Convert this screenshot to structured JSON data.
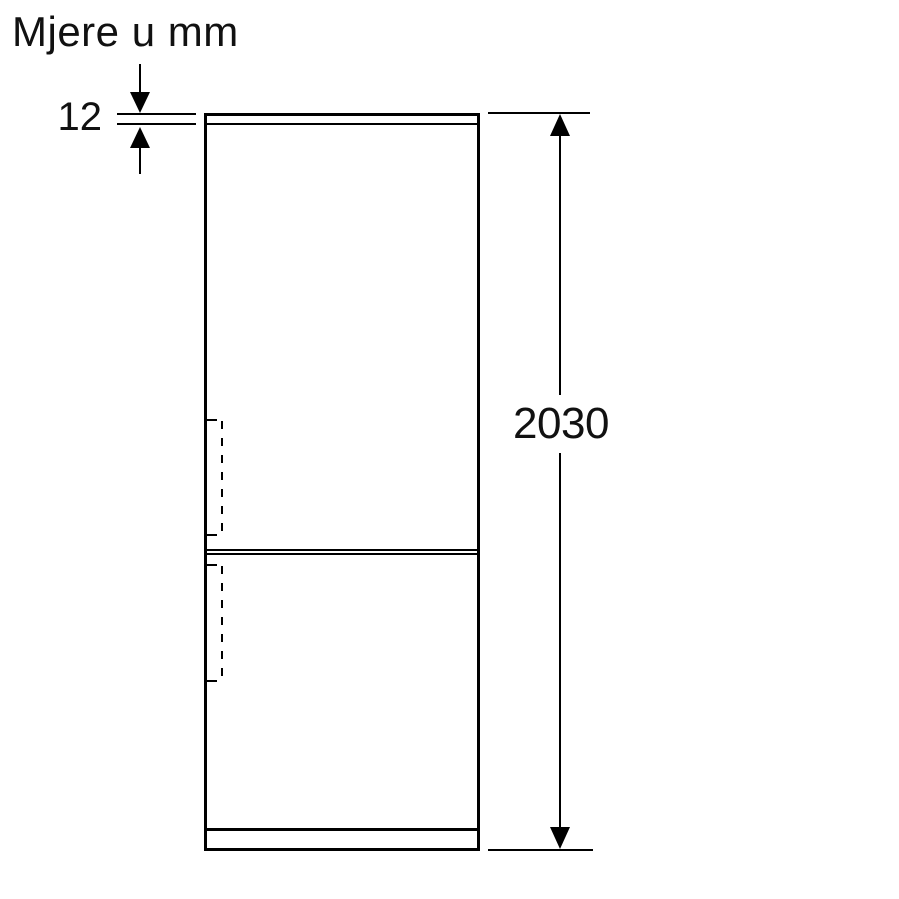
{
  "title": "Mjere u mm",
  "diagram": {
    "type": "appliance-dimension-drawing",
    "subject": "fridge-freezer-front-view",
    "background": "#ffffff",
    "line_color": "#000000",
    "text_color": "#111111",
    "dimensions": [
      {
        "id": "top-panel-thickness",
        "value": "12",
        "orientation": "vertical",
        "location": "top-left"
      },
      {
        "id": "overall-height",
        "value": "2030",
        "orientation": "vertical",
        "location": "right"
      }
    ],
    "features": [
      "top-panel-line",
      "door-divider-double-line",
      "plinth-line",
      "upper-door-handle-hidden-line",
      "lower-door-handle-hidden-line"
    ]
  }
}
